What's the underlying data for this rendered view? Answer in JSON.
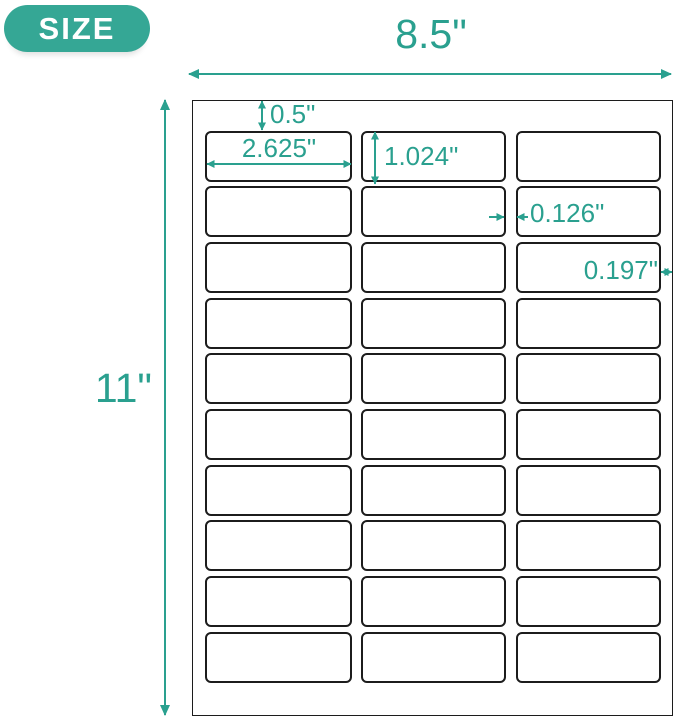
{
  "badge": {
    "label": "SIZE"
  },
  "dimensions": {
    "sheet_width": "8.5\"",
    "sheet_height": "11\"",
    "top_margin": "0.5\"",
    "label_width": "2.625\"",
    "label_height": "1.024\"",
    "column_gap": "0.126\"",
    "side_margin": "0.197\""
  },
  "sheet": {
    "rows": 10,
    "columns": 3,
    "label_count": 30
  },
  "colors": {
    "accent": "#2aa08f",
    "badge_fill": "#35a795",
    "label_border": "#1c1c1c",
    "badge_text": "#ffffff"
  }
}
